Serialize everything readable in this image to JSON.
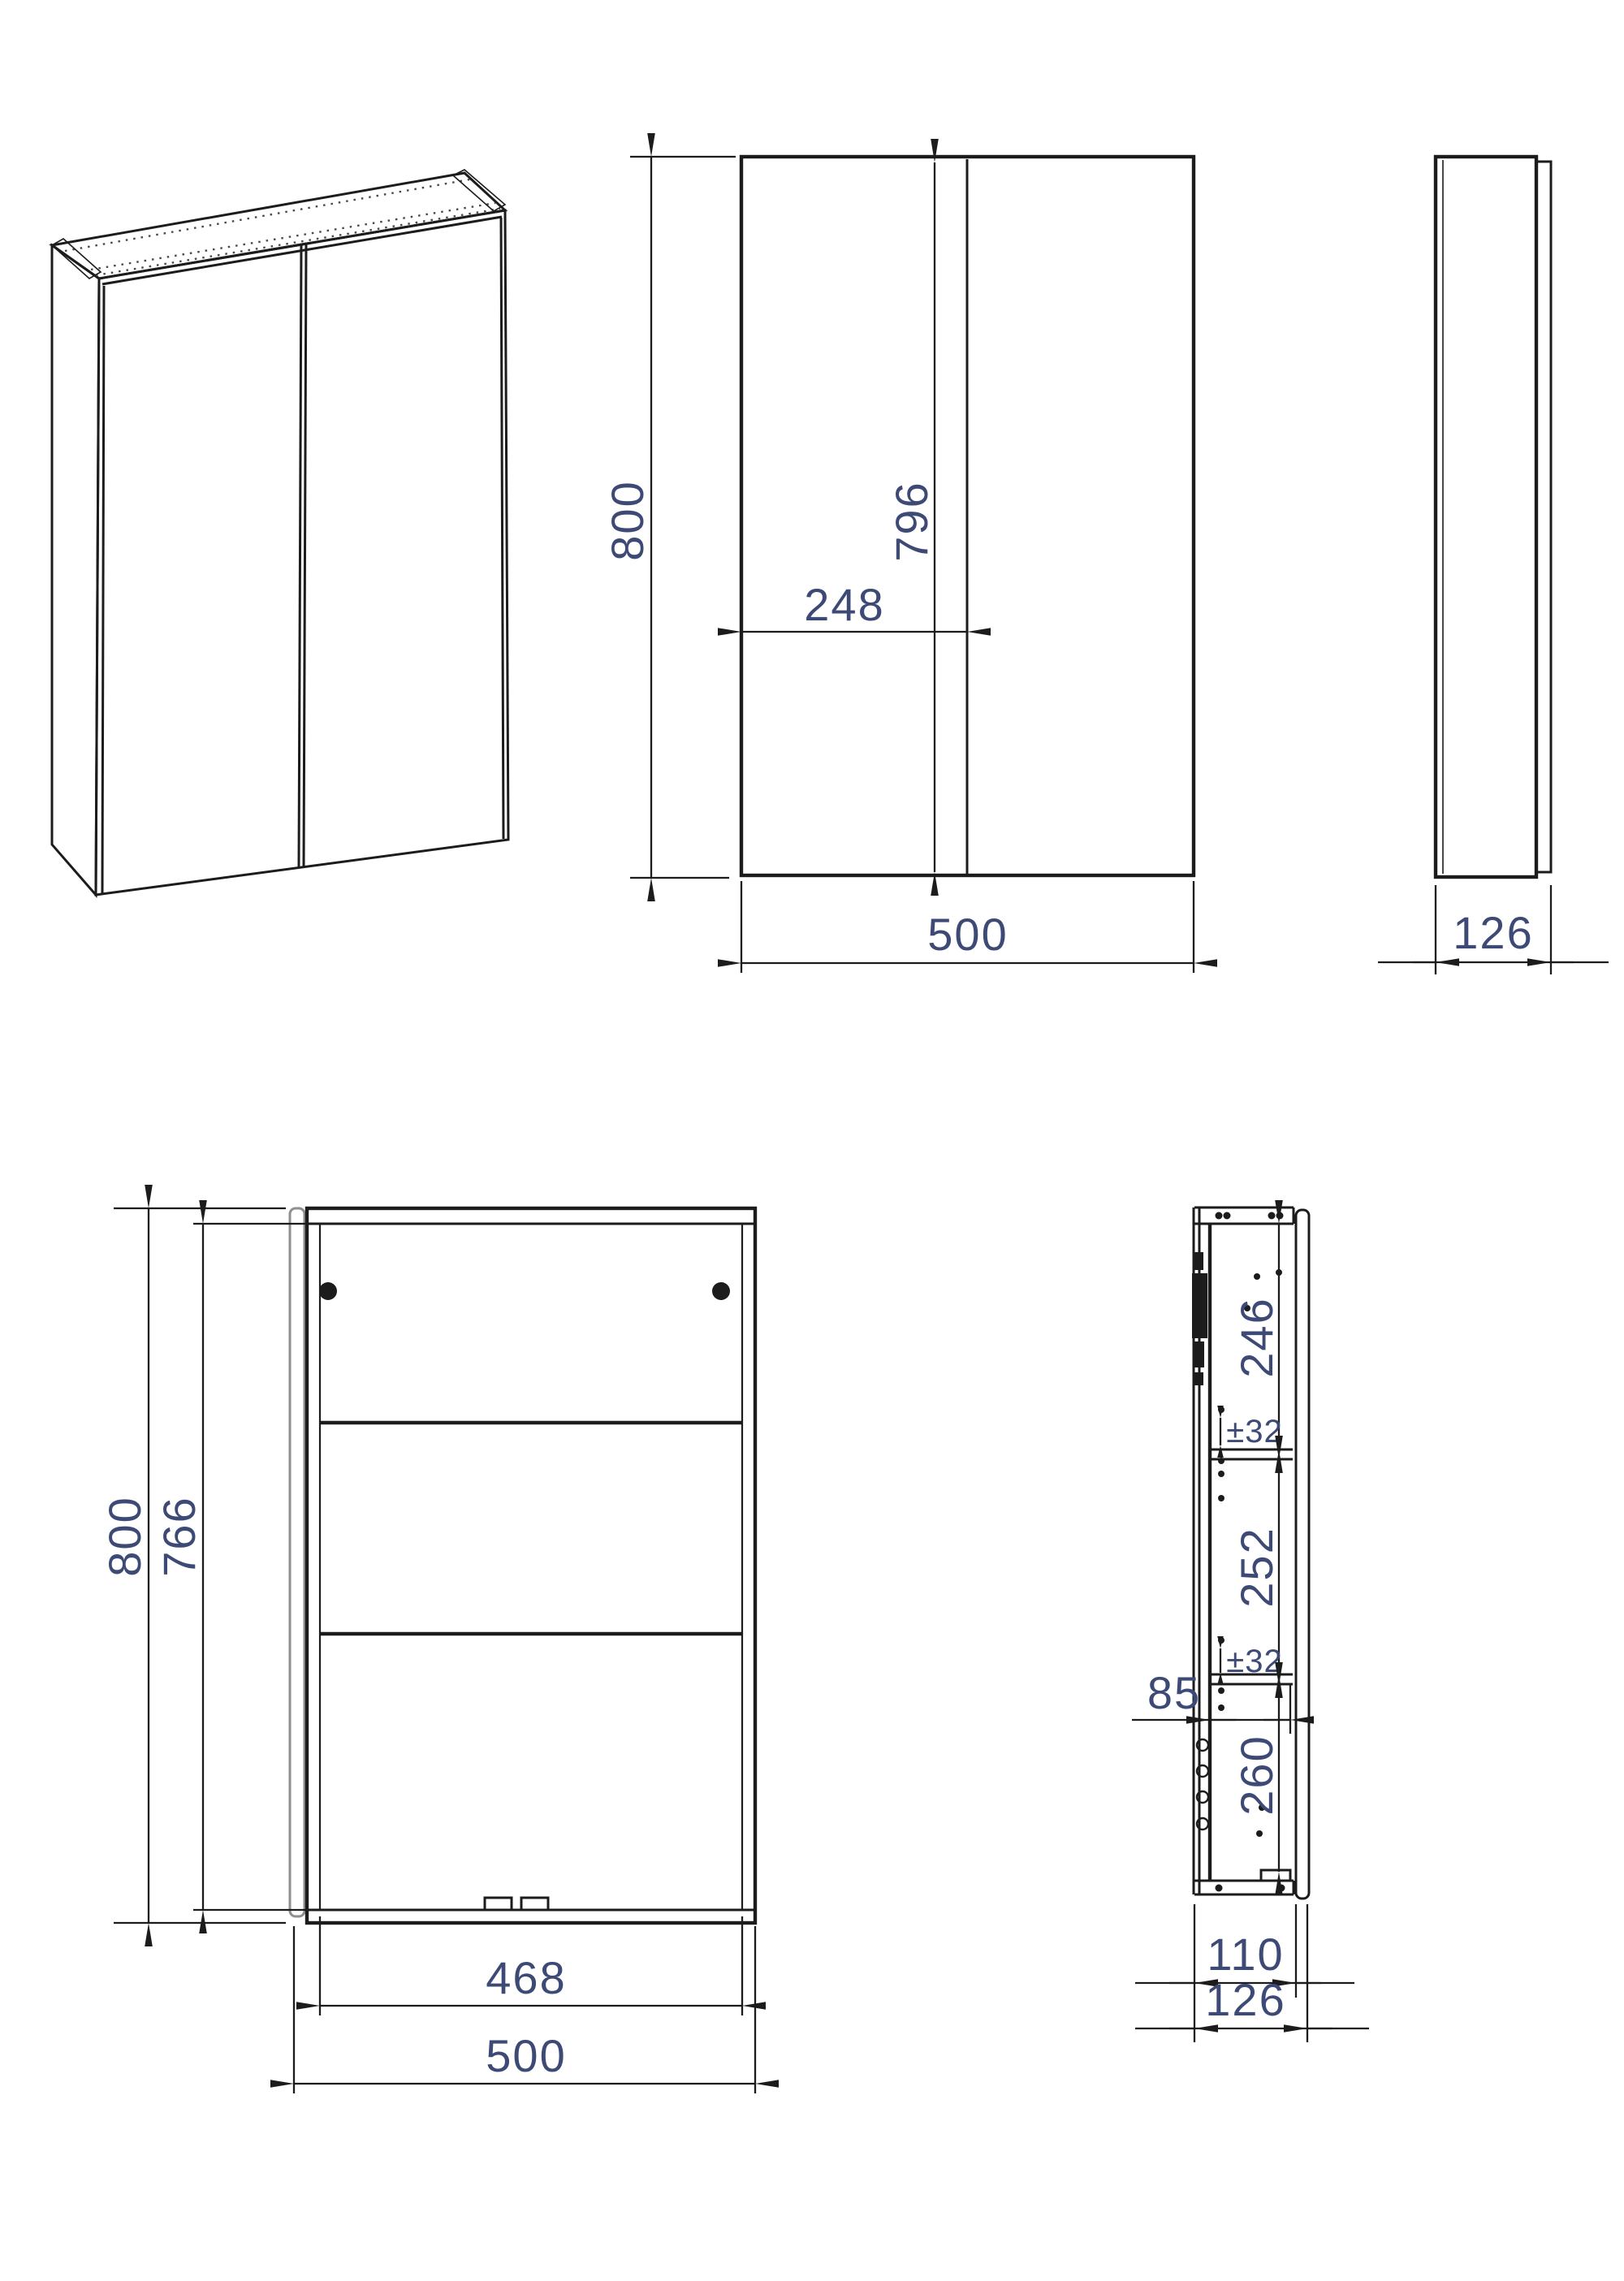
{
  "drawing_title": "two-door wall cabinet dimension drawing",
  "colors": {
    "line": "#1c1c1c",
    "dimension_text": "#3d4a75",
    "open_door_gray": "#8f8f8f"
  },
  "views": {
    "front": {
      "overall_height": "800",
      "door_height": "796",
      "left_door_width": "248",
      "overall_width": "500"
    },
    "side": {
      "overall_depth": "126"
    },
    "interior": {
      "overall_height": "800",
      "interior_height": "766",
      "interior_width": "468",
      "overall_width": "500"
    },
    "section": {
      "top_space": "246",
      "top_adjust": "±32",
      "middle_space": "252",
      "bottom_adjust": "±32",
      "front_offset": "85",
      "bottom_space": "260",
      "carcass_depth": "110",
      "overall_depth": "126"
    }
  }
}
